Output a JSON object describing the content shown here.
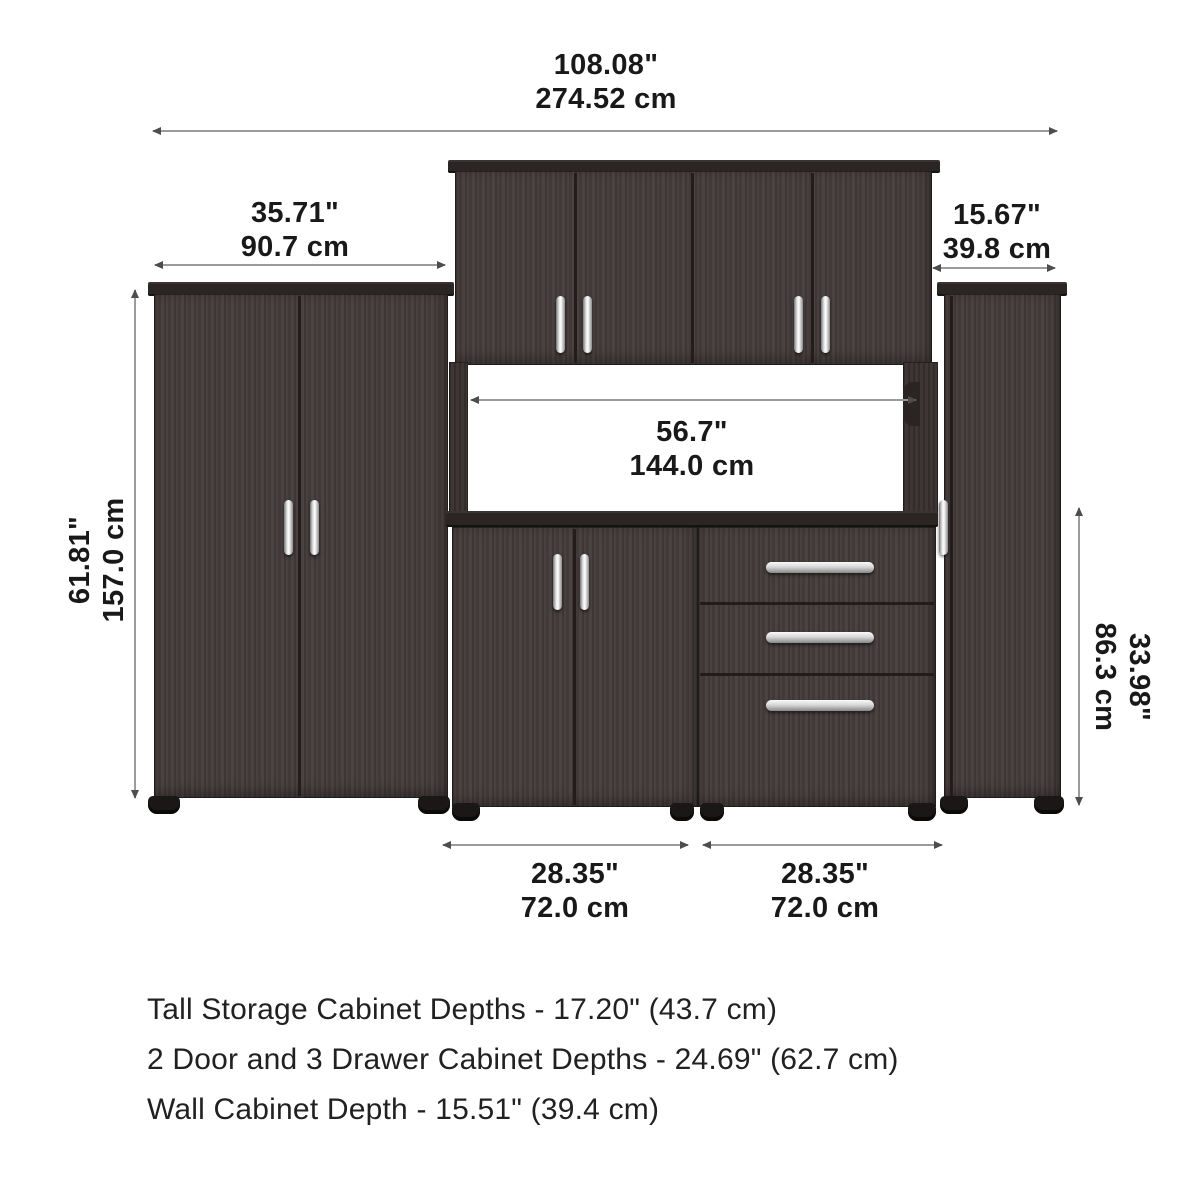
{
  "dimensions": {
    "overall_width": {
      "in": "108.08\"",
      "cm": "274.52 cm"
    },
    "left_tall_cabinet_width": {
      "in": "35.71\"",
      "cm": "90.7 cm"
    },
    "right_tall_cabinet_width": {
      "in": "15.67\"",
      "cm": "39.8 cm"
    },
    "tall_cabinet_height": {
      "in": "61.81\"",
      "cm": "157.0 cm"
    },
    "middle_opening_width": {
      "in": "56.7\"",
      "cm": "144.0 cm"
    },
    "base_cabinet_height": {
      "in": "33.98\"",
      "cm": "86.3 cm"
    },
    "base_left_cabinet_width": {
      "in": "28.35\"",
      "cm": "72.0 cm"
    },
    "base_right_cabinet_width": {
      "in": "28.35\"",
      "cm": "72.0 cm"
    }
  },
  "depth_notes": [
    "Tall Storage Cabinet Depths - 17.20\" (43.7 cm)",
    "2 Door and 3 Drawer Cabinet Depths - 24.69\" (62.7 cm)",
    "Wall Cabinet Depth - 15.51\" (39.4 cm)"
  ],
  "colors": {
    "cabinet": "#453d3c",
    "cabinet_trim": "#2b2524",
    "handle": "#e8e8e8",
    "dimension_line": "#9b9b9b",
    "dimension_arrow": "#4d4d4d",
    "text": "#191919",
    "background": "#ffffff"
  }
}
